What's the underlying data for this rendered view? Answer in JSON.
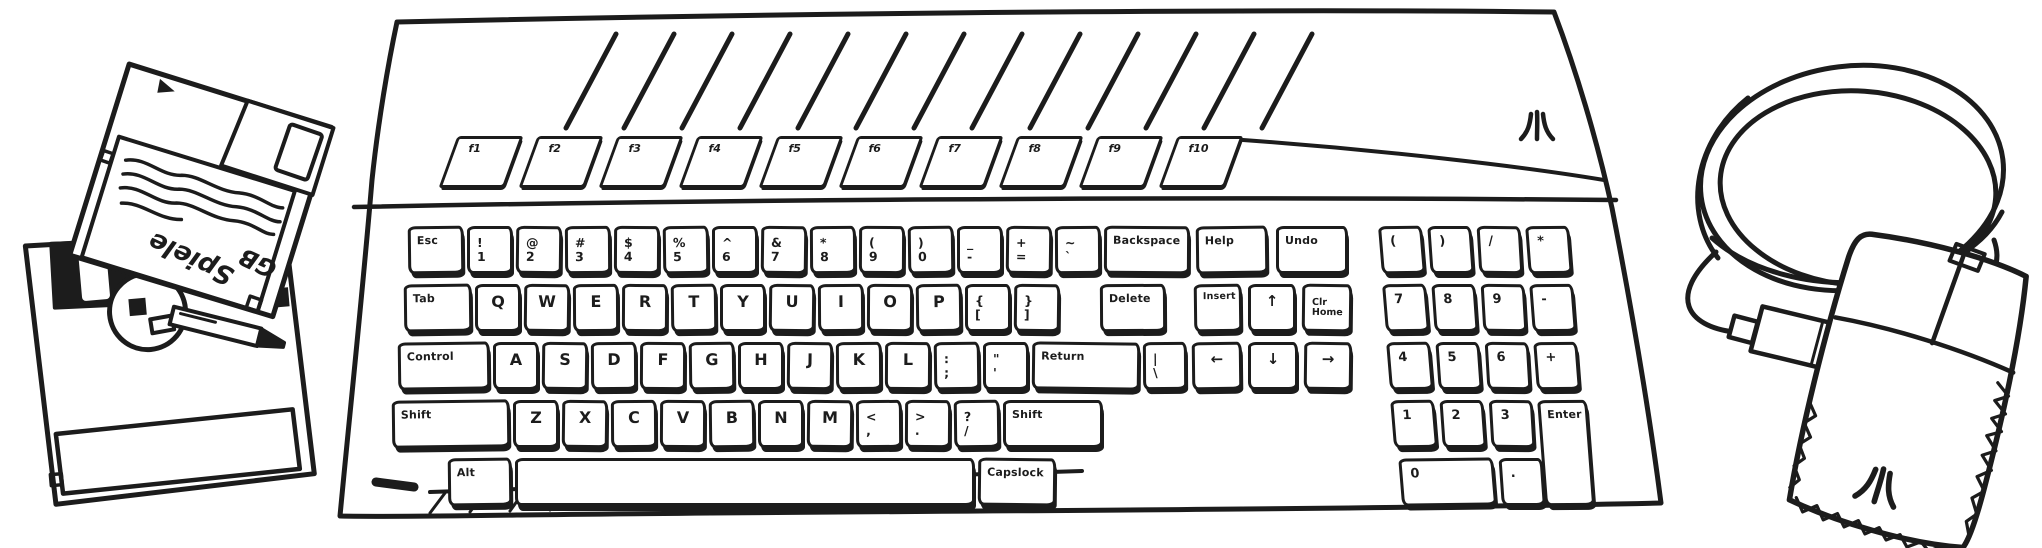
{
  "scene": {
    "ink_color": "#1c1c1c",
    "paper_color": "#ffffff"
  },
  "floppies": {
    "top_disk": {
      "label_line1": "Spiele",
      "label_line2": "GB"
    }
  },
  "logos": {
    "keyboard_badge": "atari-fuji-logo",
    "mouse_badge": "atari-fuji-logo"
  },
  "keyboard": {
    "function_row": {
      "y": 136,
      "x0": 448,
      "w": 66,
      "pitch": 80,
      "h": 52,
      "keys": [
        "f1",
        "f2",
        "f3",
        "f4",
        "f5",
        "f6",
        "f7",
        "f8",
        "f9",
        "f10"
      ]
    },
    "blocks": [
      {
        "name": "main-block",
        "rows": [
          {
            "y": 226,
            "x0": 408,
            "dw": 46,
            "gap": 3,
            "keys": [
              {
                "l": "Esc",
                "w": 56,
                "cls": "mod"
              },
              {
                "u": "!",
                "d": "1"
              },
              {
                "u": "@",
                "d": "2"
              },
              {
                "u": "#",
                "d": "3"
              },
              {
                "u": "$",
                "d": "4"
              },
              {
                "u": "%",
                "d": "5"
              },
              {
                "u": "^",
                "d": "6"
              },
              {
                "u": "&",
                "d": "7"
              },
              {
                "u": "*",
                "d": "8"
              },
              {
                "u": "(",
                "d": "9"
              },
              {
                "u": ")",
                "d": "0"
              },
              {
                "u": "_",
                "d": "-",
                "n": "minus"
              },
              {
                "u": "+",
                "d": "=",
                "n": "equals"
              },
              {
                "u": "~",
                "d": "`",
                "n": "grave"
              },
              {
                "l": "Backspace",
                "w": 86,
                "cls": "mod"
              }
            ]
          },
          {
            "y": 284,
            "x0": 404,
            "dw": 46,
            "gap": 3,
            "keys": [
              {
                "l": "Tab",
                "w": 68,
                "cls": "mod"
              },
              {
                "l": "Q"
              },
              {
                "l": "W"
              },
              {
                "l": "E"
              },
              {
                "l": "R"
              },
              {
                "l": "T"
              },
              {
                "l": "Y"
              },
              {
                "l": "U"
              },
              {
                "l": "I"
              },
              {
                "l": "O"
              },
              {
                "l": "P"
              },
              {
                "u": "{",
                "d": "[",
                "n": "bracket-open"
              },
              {
                "u": "}",
                "d": "]",
                "n": "bracket-close"
              },
              {
                "l": "Delete",
                "w": 66,
                "x": 1100,
                "cls": "mod"
              }
            ]
          },
          {
            "y": 342,
            "x0": 398,
            "dw": 46,
            "gap": 3,
            "keys": [
              {
                "l": "Control",
                "w": 92,
                "cls": "mod"
              },
              {
                "l": "A"
              },
              {
                "l": "S"
              },
              {
                "l": "D"
              },
              {
                "l": "F"
              },
              {
                "l": "G"
              },
              {
                "l": "H"
              },
              {
                "l": "J"
              },
              {
                "l": "K"
              },
              {
                "l": "L"
              },
              {
                "u": ":",
                "d": ";",
                "n": "semicolon"
              },
              {
                "u": "\"",
                "d": "'",
                "n": "quote"
              },
              {
                "l": "Return",
                "w": 108,
                "cls": "mod"
              },
              {
                "u": "|",
                "d": "\\",
                "w": 44,
                "n": "backslash"
              }
            ]
          },
          {
            "y": 400,
            "x0": 392,
            "dw": 46,
            "gap": 3,
            "keys": [
              {
                "l": "Shift",
                "w": 118,
                "cls": "mod",
                "n": "shift-left"
              },
              {
                "l": "Z"
              },
              {
                "l": "X"
              },
              {
                "l": "C"
              },
              {
                "l": "V"
              },
              {
                "l": "B"
              },
              {
                "l": "N"
              },
              {
                "l": "M"
              },
              {
                "u": "<",
                "d": ",",
                "n": "comma"
              },
              {
                "u": ">",
                "d": ".",
                "n": "period"
              },
              {
                "u": "?",
                "d": "/",
                "n": "slash"
              },
              {
                "l": "Shift",
                "w": 100,
                "cls": "mod",
                "n": "shift-right"
              }
            ]
          },
          {
            "y": 458,
            "x0": 448,
            "dw": 46,
            "gap": 3,
            "keys": [
              {
                "l": "Alt",
                "w": 64,
                "cls": "mod"
              },
              {
                "l": "",
                "w": 460,
                "cls": "space",
                "n": "space-bar"
              },
              {
                "l": "Capslock",
                "w": 78,
                "cls": "mod"
              }
            ]
          }
        ]
      },
      {
        "name": "nav-block",
        "rows": [
          {
            "y": 226,
            "x0": 1196,
            "dw": 72,
            "gap": 8,
            "keys": [
              {
                "l": "Help",
                "cls": "mod"
              },
              {
                "l": "Undo",
                "cls": "mod"
              }
            ]
          },
          {
            "y": 284,
            "x0": 1194,
            "dw": 48,
            "gap": 6,
            "keys": [
              {
                "l": "Insert",
                "cls": "mod sm"
              },
              {
                "l": "↑",
                "cls": "arr",
                "n": "up-arrow"
              },
              {
                "u": "Clr",
                "d": "Home",
                "w": 50,
                "cls": "sm",
                "n": "clr-home"
              }
            ]
          },
          {
            "y": 342,
            "x0": 1192,
            "dw": 50,
            "gap": 6,
            "keys": [
              {
                "l": "←",
                "cls": "arr",
                "n": "left-arrow"
              },
              {
                "l": "↓",
                "cls": "arr",
                "n": "down-arrow"
              },
              {
                "l": "→",
                "w": 48,
                "cls": "arr",
                "n": "right-arrow"
              }
            ]
          }
        ]
      },
      {
        "name": "numpad-block",
        "skew": 4,
        "origin": [
          1378,
          222
        ],
        "rows": [
          {
            "y": 226,
            "x0": 1378,
            "dw": 44,
            "gap": 5,
            "keys": [
              {
                "l": "(",
                "cls": "np",
                "n": "numpad-open-paren"
              },
              {
                "l": ")",
                "cls": "np",
                "n": "numpad-close-paren"
              },
              {
                "l": "/",
                "cls": "np",
                "n": "numpad-divide"
              },
              {
                "l": "*",
                "cls": "np",
                "n": "numpad-multiply"
              }
            ]
          },
          {
            "y": 284,
            "x0": 1378,
            "dw": 44,
            "gap": 5,
            "keys": [
              {
                "l": "7",
                "cls": "np",
                "n": "numpad-7"
              },
              {
                "l": "8",
                "cls": "np",
                "n": "numpad-8"
              },
              {
                "l": "9",
                "cls": "np",
                "n": "numpad-9"
              },
              {
                "l": "-",
                "cls": "np",
                "n": "numpad-minus"
              }
            ]
          },
          {
            "y": 342,
            "x0": 1378,
            "dw": 44,
            "gap": 5,
            "keys": [
              {
                "l": "4",
                "cls": "np",
                "n": "numpad-4"
              },
              {
                "l": "5",
                "cls": "np",
                "n": "numpad-5"
              },
              {
                "l": "6",
                "cls": "np",
                "n": "numpad-6"
              },
              {
                "l": "+",
                "cls": "np",
                "n": "numpad-plus"
              }
            ]
          },
          {
            "y": 400,
            "x0": 1378,
            "dw": 44,
            "gap": 5,
            "keys": [
              {
                "l": "1",
                "cls": "np",
                "n": "numpad-1"
              },
              {
                "l": "2",
                "cls": "np",
                "n": "numpad-2"
              },
              {
                "l": "3",
                "cls": "np",
                "n": "numpad-3"
              },
              {
                "l": "Enter",
                "w": 50,
                "h": 106,
                "cls": "mod",
                "n": "numpad-enter"
              }
            ]
          },
          {
            "y": 458,
            "x0": 1382,
            "dw": 44,
            "gap": 5,
            "keys": [
              {
                "l": "0",
                "w": 95,
                "cls": "np",
                "n": "numpad-0"
              },
              {
                "l": ".",
                "x": 1482,
                "cls": "np",
                "n": "numpad-dot"
              }
            ]
          }
        ]
      }
    ]
  }
}
